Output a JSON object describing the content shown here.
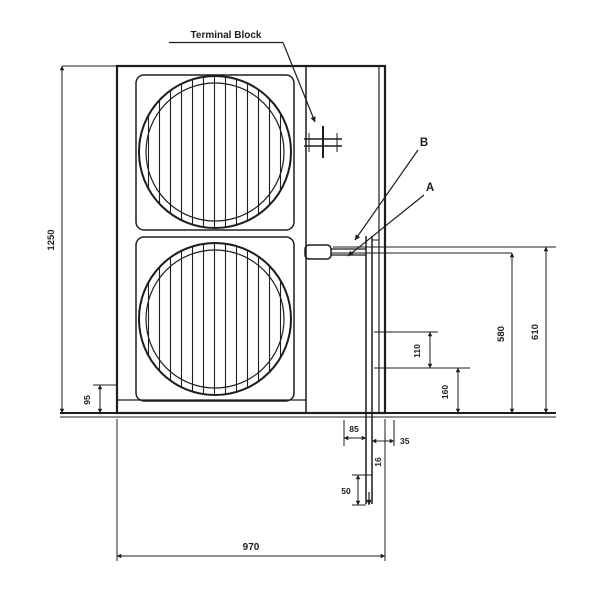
{
  "drawing": {
    "labels": {
      "terminal_block": "Terminal Block",
      "callout_b": "B",
      "callout_a": "A"
    },
    "dimensions": {
      "overall_height": "1250",
      "overall_width": "970",
      "base_height": "95",
      "valve_a_height": "580",
      "valve_b_height": "610",
      "pipe_upper": "110",
      "pipe_lower": "160",
      "drain_left": "85",
      "drain_right": "35",
      "drain_dia": "16",
      "drain_length": "50"
    },
    "colors": {
      "line": "#1d1d1f",
      "background": "#ffffff"
    }
  }
}
